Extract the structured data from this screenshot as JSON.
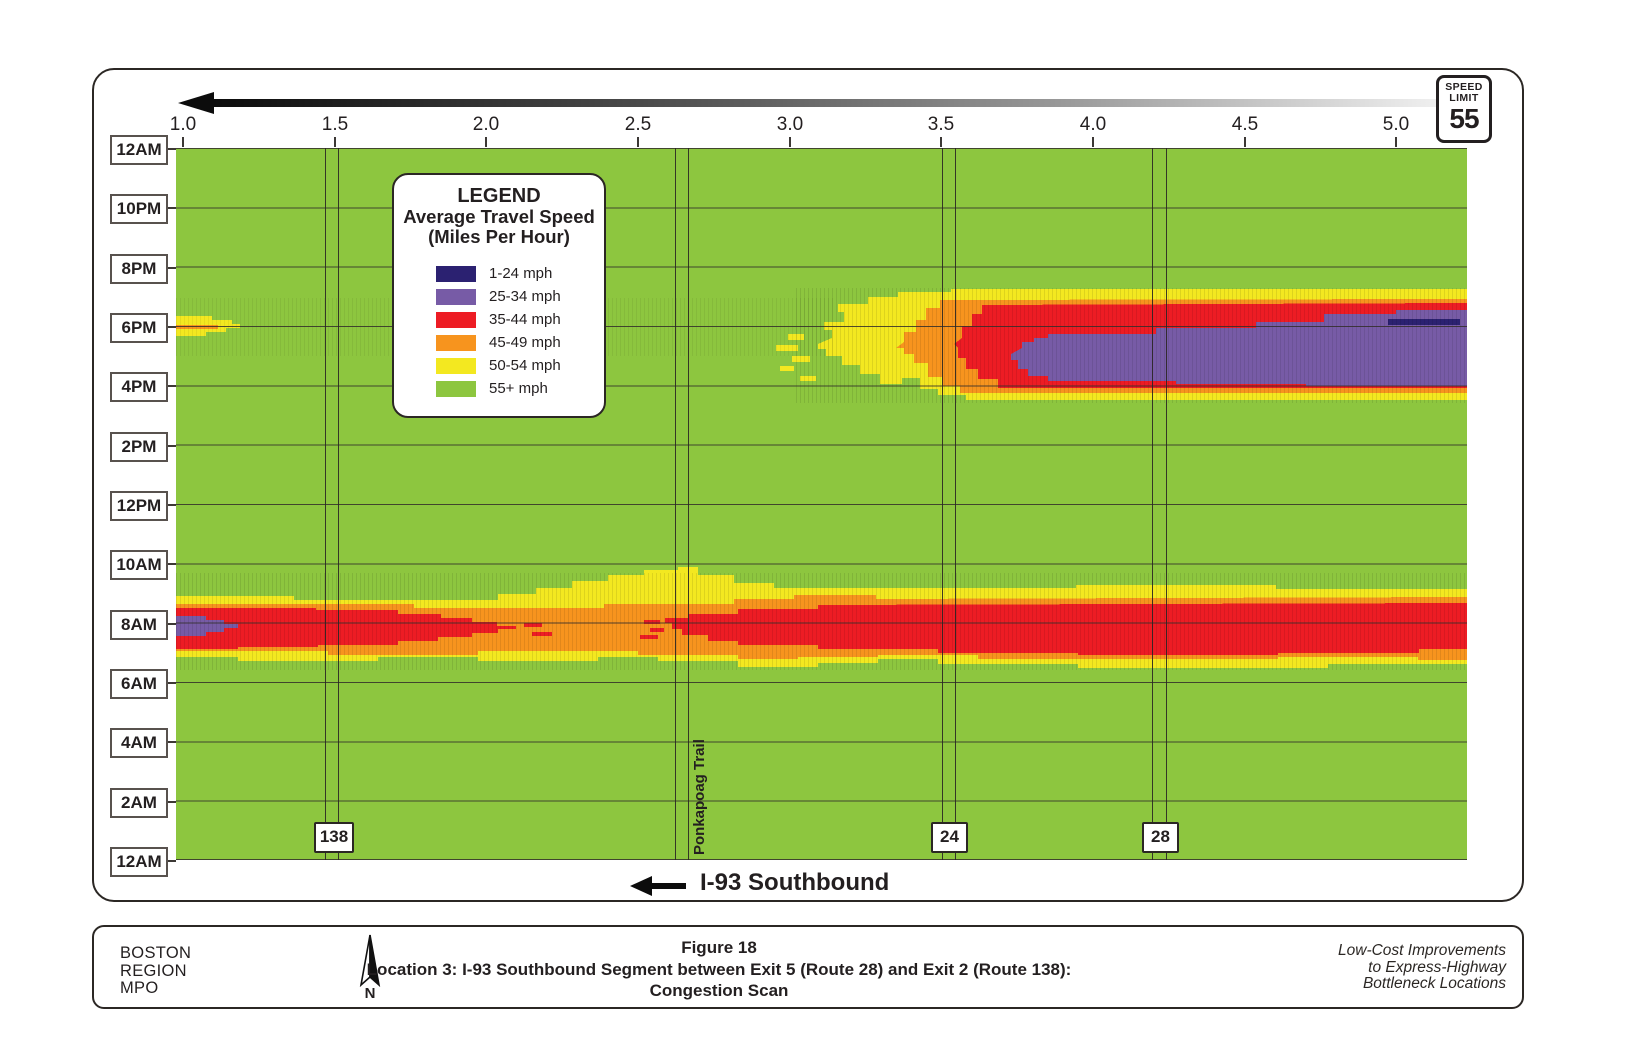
{
  "speed_sign": {
    "line1": "SPEED",
    "line2": "LIMIT",
    "value": "55"
  },
  "x_axis": {
    "ticks": [
      "1.0",
      "1.5",
      "2.0",
      "2.5",
      "3.0",
      "3.5",
      "4.0",
      "4.5",
      "5.0"
    ]
  },
  "y_axis": {
    "labels": [
      "12AM",
      "10PM",
      "8PM",
      "6PM",
      "4PM",
      "2PM",
      "12PM",
      "10AM",
      "8AM",
      "6AM",
      "4AM",
      "2AM",
      "12AM"
    ]
  },
  "legend": {
    "title": "LEGEND",
    "subtitle1": "Average Travel Speed",
    "subtitle2": "(Miles Per Hour)",
    "entries": [
      {
        "label": "1-24 mph",
        "color": "#2b2171"
      },
      {
        "label": "25-34 mph",
        "color": "#775ba6"
      },
      {
        "label": "35-44 mph",
        "color": "#ed1c24"
      },
      {
        "label": "45-49 mph",
        "color": "#f7941e"
      },
      {
        "label": "50-54 mph",
        "color": "#f3e820"
      },
      {
        "label": "55+ mph",
        "color": "#8dc63f"
      }
    ]
  },
  "road_labels": {
    "route_138": "138",
    "ponkapoag": "Ponkapoag Trail",
    "route_24": "24",
    "route_28": "28"
  },
  "direction_label": "I-93 Southbound",
  "footer": {
    "org_line1": "BOSTON",
    "org_line2": "REGION",
    "org_line3": "MPO",
    "north_label": "N",
    "title_line1": "Figure 18",
    "title_line2": "Location 3: I-93 Southbound Segment between Exit 5 (Route 28) and Exit 2 (Route 138):",
    "title_line3": "Congestion Scan",
    "right_line1": "Low-Cost Improvements",
    "right_line2": "to Express-Highway",
    "right_line3": "Bottleneck Locations"
  },
  "chart_data": {
    "type": "heatmap",
    "title": "Congestion Scan - I-93 Southbound between Exit 5 (Route 28) and Exit 2 (Route 138)",
    "x_axis": {
      "label": "milepost (miles)",
      "tick_labels": [
        1.0,
        1.5,
        2.0,
        2.5,
        3.0,
        3.5,
        4.0,
        4.5,
        5.0
      ],
      "range": [
        0.97,
        5.23
      ],
      "flow_direction": "right to left (southbound arrow)"
    },
    "y_axis": {
      "label": "time of day",
      "tick_labels": [
        "12AM",
        "10PM",
        "8PM",
        "6PM",
        "4PM",
        "2PM",
        "12PM",
        "10AM",
        "8AM",
        "6AM",
        "4AM",
        "2AM",
        "12AM"
      ],
      "orientation": "midnight at top, descending through evening to morning, midnight at bottom"
    },
    "speed_bins": [
      {
        "label": "1-24 mph",
        "color": "#2b2171"
      },
      {
        "label": "25-34 mph",
        "color": "#775ba6"
      },
      {
        "label": "35-44 mph",
        "color": "#ed1c24"
      },
      {
        "label": "45-49 mph",
        "color": "#f7941e"
      },
      {
        "label": "50-54 mph",
        "color": "#f3e820"
      },
      {
        "label": "55+ mph",
        "color": "#8dc63f"
      }
    ],
    "baseline_value": "55+ mph (green) at all other hours/locations",
    "posted_speed_limit_mph": 55,
    "congestion_regions": [
      {
        "name": "pm_peak",
        "time_span": "about 3:30PM-6:30PM",
        "mile_span": [
          3.1,
          5.2
        ],
        "detail": "35-44 mph (red) envelope with large 25-34 mph (purple) core between 4PM and 6PM from about mile 3.8 to mile 5.2; short 1-24 mph (navy) streak near mile 5.0 around 5:30PM; 45-54 mph fringes; ragged 50-54 mph tip reaching back to about mile 3.1"
      },
      {
        "name": "am_peak",
        "time_span": "about 6AM-9AM",
        "mile_span": [
          1.0,
          5.2
        ],
        "detail": "corridor-wide band centered near 7-8AM: 35-44 mph (red) from mile 1.0 to about 2.1 and from about 2.6 to 5.2, easing to 45-49 mph (orange) near miles 2.1-2.6 and at the far right edge; small 25-34 mph (purple) pocket at mile 1.0 near 8AM; 50-54 mph (yellow) fringes"
      },
      {
        "name": "pm_minor_left_edge",
        "time_span": "about 5PM-6PM",
        "mile_span": [
          1.0,
          1.2
        ],
        "detail": "small 50-54 mph wedge with thin 45-49 mph streak at the left edge near 5PM"
      }
    ],
    "landmarks": [
      {
        "label": "138",
        "mile": 1.5
      },
      {
        "label": "Ponkapoag Trail",
        "mile": 2.6
      },
      {
        "label": "24",
        "mile": 3.5
      },
      {
        "label": "28",
        "mile": 4.2
      }
    ],
    "grid": "horizontal gridlines every 2 hours; paired vertical lines at each landmark crossing"
  }
}
